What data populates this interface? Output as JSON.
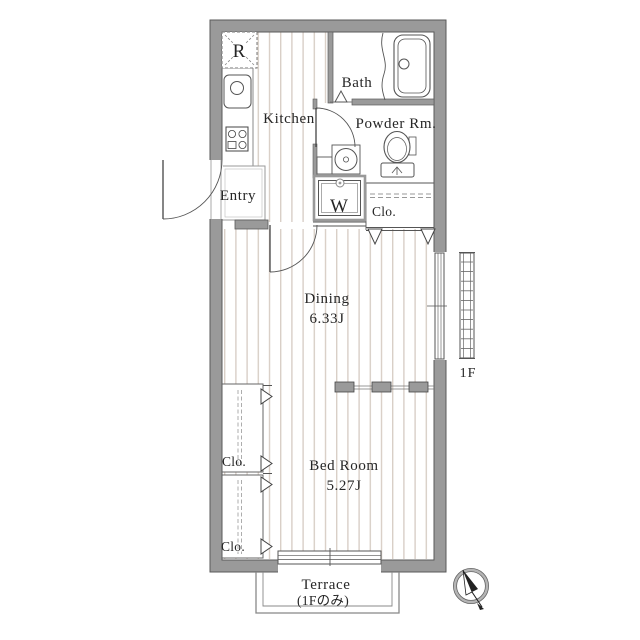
{
  "plan": {
    "rooms": {
      "kitchen": {
        "label": "Kitchen"
      },
      "bath": {
        "label": "Bath"
      },
      "powder_room": {
        "label": "Powder Rm."
      },
      "entry": {
        "label": "Entry"
      },
      "dining": {
        "label": "Dining",
        "size": "6.33J"
      },
      "bedroom": {
        "label": "Bed Room",
        "size": "5.27J"
      },
      "terrace": {
        "label": "Terrace",
        "note": "(1Fのみ)"
      }
    },
    "closets": {
      "hall": {
        "label": "Clo."
      },
      "bedroom_upper": {
        "label": "Clo."
      },
      "bedroom_lower": {
        "label": "Clo."
      }
    },
    "appliances": {
      "refrigerator": {
        "label": "R"
      },
      "washing_machine": {
        "label": "W"
      }
    },
    "floor_indicator": "1F",
    "colors": {
      "wall": "#9a9a9a",
      "floor_stripe": "#d9cfc7",
      "outline": "#555555"
    }
  }
}
